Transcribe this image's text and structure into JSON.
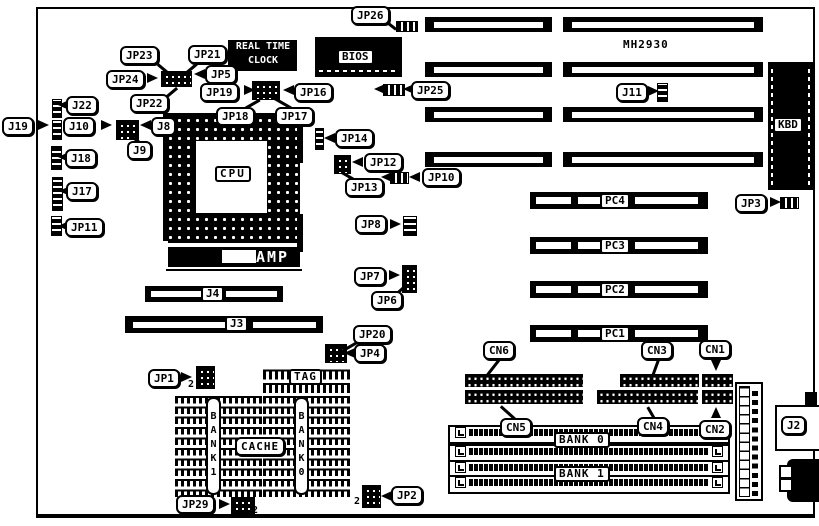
{
  "board": {
    "model": "MH2930"
  },
  "chips": {
    "rtc1": "REAL TIME",
    "rtc2": "CLOCK",
    "bios": "BIOS",
    "cpu": "CPU",
    "amp": "AMP",
    "kbd": "KBD",
    "tag": "TAG",
    "cache": "CACHE",
    "bank1_v": "BANK1",
    "bank0_v": "BANK0"
  },
  "slots": {
    "pc4": "PC4",
    "pc3": "PC3",
    "pc2": "PC2",
    "pc1": "PC1",
    "j4": "J4",
    "j3": "J3",
    "bank0": "BANK 0",
    "bank1": "BANK 1"
  },
  "labels": {
    "jp26": "JP26",
    "jp23": "JP23",
    "jp21": "JP21",
    "jp24": "JP24",
    "jp5": "JP5",
    "jp22": "JP22",
    "jp19": "JP19",
    "jp16": "JP16",
    "jp18": "JP18",
    "jp17": "JP17",
    "j22": "J22",
    "j19": "J19",
    "j10": "J10",
    "j8": "J8",
    "j9": "J9",
    "j18": "J18",
    "j17": "J17",
    "jp11": "JP11",
    "jp14": "JP14",
    "jp12": "JP12",
    "jp13": "JP13",
    "jp10": "JP10",
    "jp25": "JP25",
    "j11": "J11",
    "jp3": "JP3",
    "jp8": "JP8",
    "jp7": "JP7",
    "jp6": "JP6",
    "jp20": "JP20",
    "jp4": "JP4",
    "jp1": "JP1",
    "jp29": "JP29",
    "jp2": "JP2",
    "j2": "J2",
    "cn6": "CN6",
    "cn3": "CN3",
    "cn1": "CN1",
    "cn5": "CN5",
    "cn4": "CN4",
    "cn2": "CN2"
  },
  "markers": {
    "pin2": "2"
  }
}
